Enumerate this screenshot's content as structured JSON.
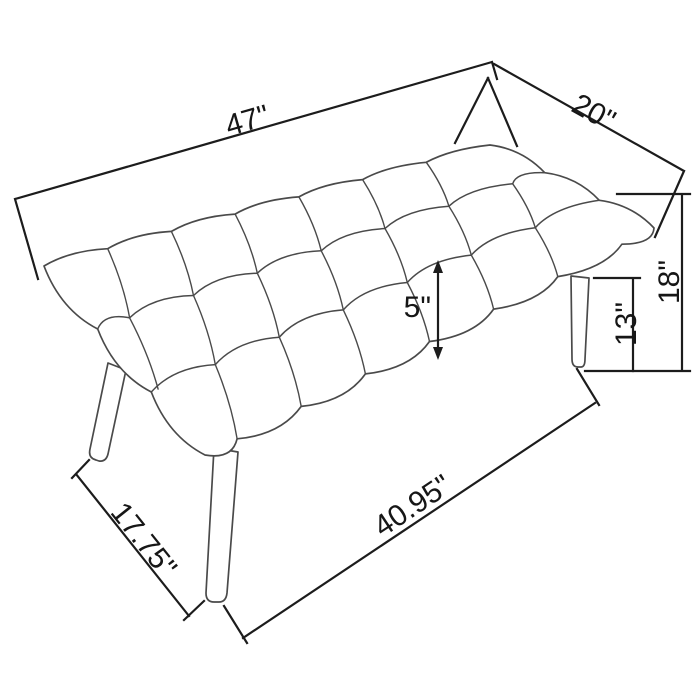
{
  "diagram": {
    "background": "#ffffff",
    "colors": {
      "dimension_line": "#1c1c1c",
      "sketch_line": "#4a4a4a"
    },
    "labels": {
      "top_length": "47\"",
      "depth": "20\"",
      "cushion_thickness": "5\"",
      "leg_height": "13\"",
      "overall_height": "18\"",
      "front_leg_spread": "17.75\"",
      "base_length": "40.95\""
    }
  }
}
